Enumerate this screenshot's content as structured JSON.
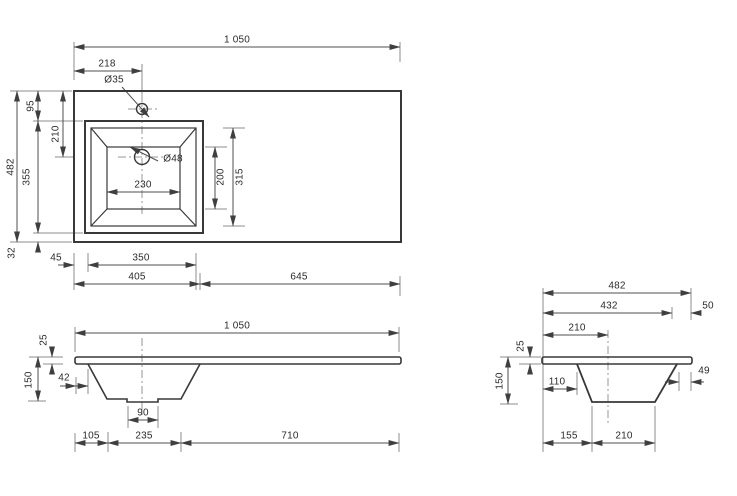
{
  "drawing_type": "washbasin-dimension-drawing",
  "top_view": {
    "overall_width": "1 050",
    "faucet_offset": "218",
    "faucet_hole_dia": "Ø35",
    "overall_depth": "482",
    "top_margin": "95",
    "drain_center_from_top": "210",
    "basin_outer_depth": "355",
    "bottom_margin": "32",
    "left_margin": "45",
    "basin_outer_width": "350",
    "left_section_width": "405",
    "right_section_width": "645",
    "drain_hole_dia": "Ø48",
    "bowl_floor_width": "230",
    "bowl_floor_depth": "200",
    "bowl_inner_depth": "315"
  },
  "front_view": {
    "overall_width": "1 050",
    "countertop_thickness": "25",
    "overall_height": "150",
    "bowl_left_offset": "42",
    "drain_boss_width": "90",
    "left_margin": "105",
    "bowl_bottom_width": "235",
    "right_section_width": "710"
  },
  "side_view": {
    "overall_depth": "482",
    "front_to_bowl_back": "432",
    "back_margin": "50",
    "drain_center_from_front": "210",
    "countertop_thickness": "25",
    "overall_height": "150",
    "front_to_bowl_top": "110",
    "back_to_bowl_top": "49",
    "front_margin": "155",
    "bowl_bottom_depth": "210"
  }
}
